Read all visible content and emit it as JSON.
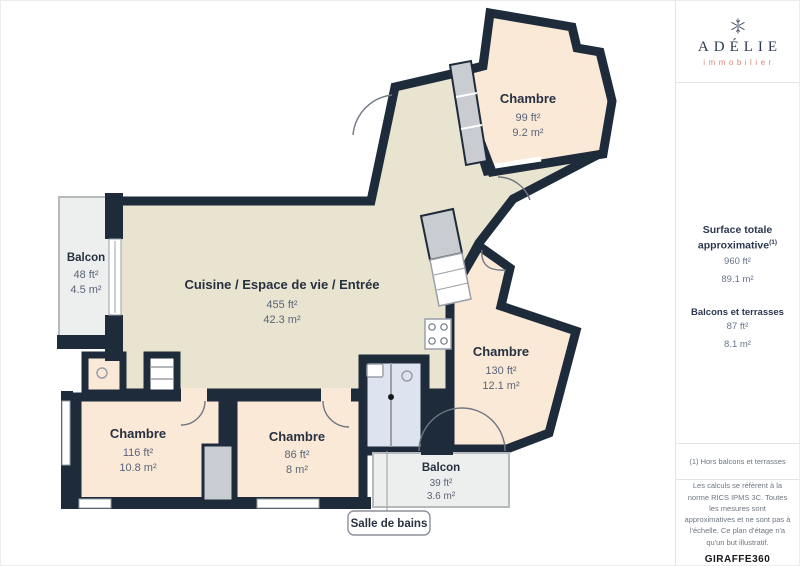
{
  "brand": {
    "name": "ADÉLIE",
    "tagline": "immobilier",
    "star_icon": "snowflake-star-icon"
  },
  "sidebar": {
    "surface_title": "Surface totale approximative",
    "surface_title_sup": "(1)",
    "surface_ft": "960 ft²",
    "surface_m": "89.1 m²",
    "balconies_title": "Balcons et terrasses",
    "balconies_ft": "87 ft²",
    "balconies_m": "8.1 m²",
    "footnote": "(1) Hors balcons et terrasses",
    "disclaimer": "Les calculs se réfèrent à la norme RICS IPMS 3C. Toutes les mesures sont approximatives et ne sont pas à l'échelle. Ce plan d'étage n'a qu'un but illustratif.",
    "watermark_bold": "GIRAFFE",
    "watermark_rest": "360"
  },
  "rooms": [
    {
      "name": "Chambre",
      "area_ft": "99 ft²",
      "area_m": "9.2 m²"
    },
    {
      "name": "Balcon",
      "area_ft": "48 ft²",
      "area_m": "4.5 m²"
    },
    {
      "name": "Cuisine / Espace de vie / Entrée",
      "area_ft": "455 ft²",
      "area_m": "42.3 m²"
    },
    {
      "name": "Chambre",
      "area_ft": "130 ft²",
      "area_m": "12.1 m²"
    },
    {
      "name": "Chambre",
      "area_ft": "116 ft²",
      "area_m": "10.8 m²"
    },
    {
      "name": "Chambre",
      "area_ft": "86 ft²",
      "area_m": "8 m²"
    },
    {
      "name": "Balcon",
      "area_ft": "39 ft²",
      "area_m": "3.6 m²"
    },
    {
      "name": "Salle de bains"
    }
  ],
  "colors": {
    "wall": "#1e2b3a",
    "floor_main": "#e9e4d0",
    "floor_bedroom": "#fbe9d8",
    "floor_bath": "#dde4f0",
    "floor_balcony": "#edeeee",
    "closet": "#c9ccd0",
    "tagline_accent": "#dd8672",
    "text_navy": "#2b3850"
  }
}
